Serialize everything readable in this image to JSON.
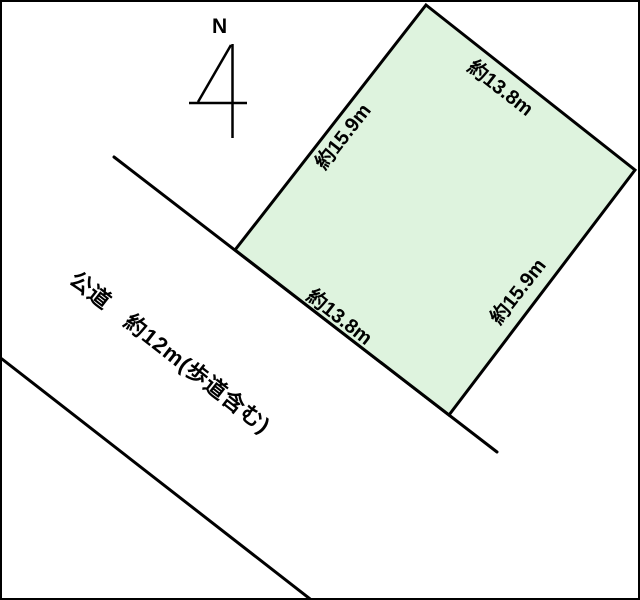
{
  "page": {
    "background": "#ffffff",
    "border_color": "#000000",
    "line_color": "#000000",
    "plot_fill": "#def3de"
  },
  "compass": {
    "north_label": "N"
  },
  "plot": {
    "dim_top_right": "約13.8m",
    "dim_top_left": "約15.9m",
    "dim_bottom": "約13.8m",
    "dim_right": "約15.9m"
  },
  "road": {
    "label": "公道　約12m(歩道含む)"
  }
}
